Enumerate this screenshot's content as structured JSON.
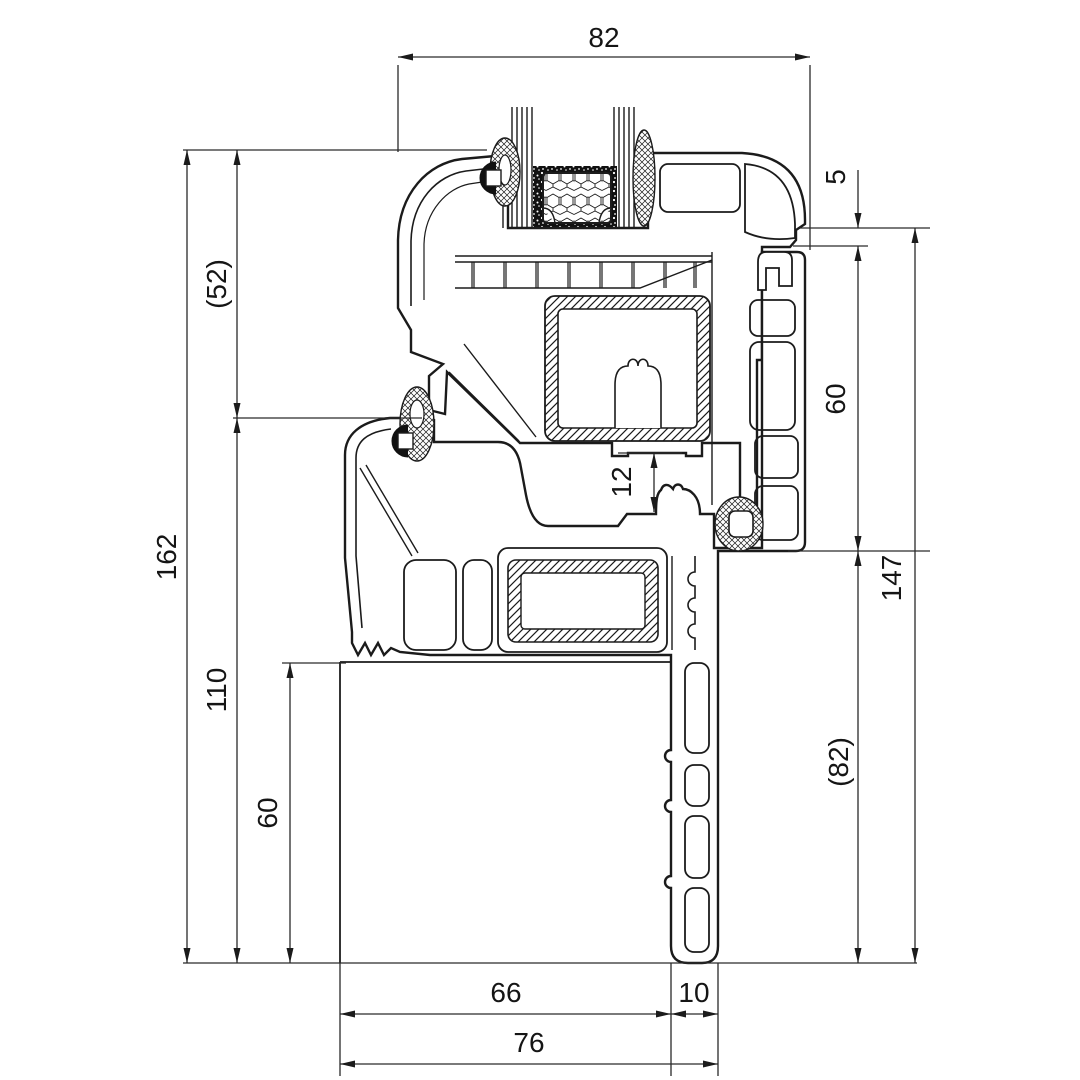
{
  "drawing": {
    "kind": "window-profile-cross-section",
    "units": "mm",
    "line_color": "#1b1b1b",
    "background_color": "#ffffff"
  },
  "dims": {
    "top_width": "82",
    "left_total_height": "162",
    "left_upper": "(52)",
    "left_mid": "110",
    "left_lower": "60",
    "right_gap": "5",
    "right_frame": "60",
    "right_total": "147",
    "right_leg": "(82)",
    "middle_rebate": "12",
    "bottom_inner": "66",
    "bottom_leg": "10",
    "bottom_total": "76"
  }
}
